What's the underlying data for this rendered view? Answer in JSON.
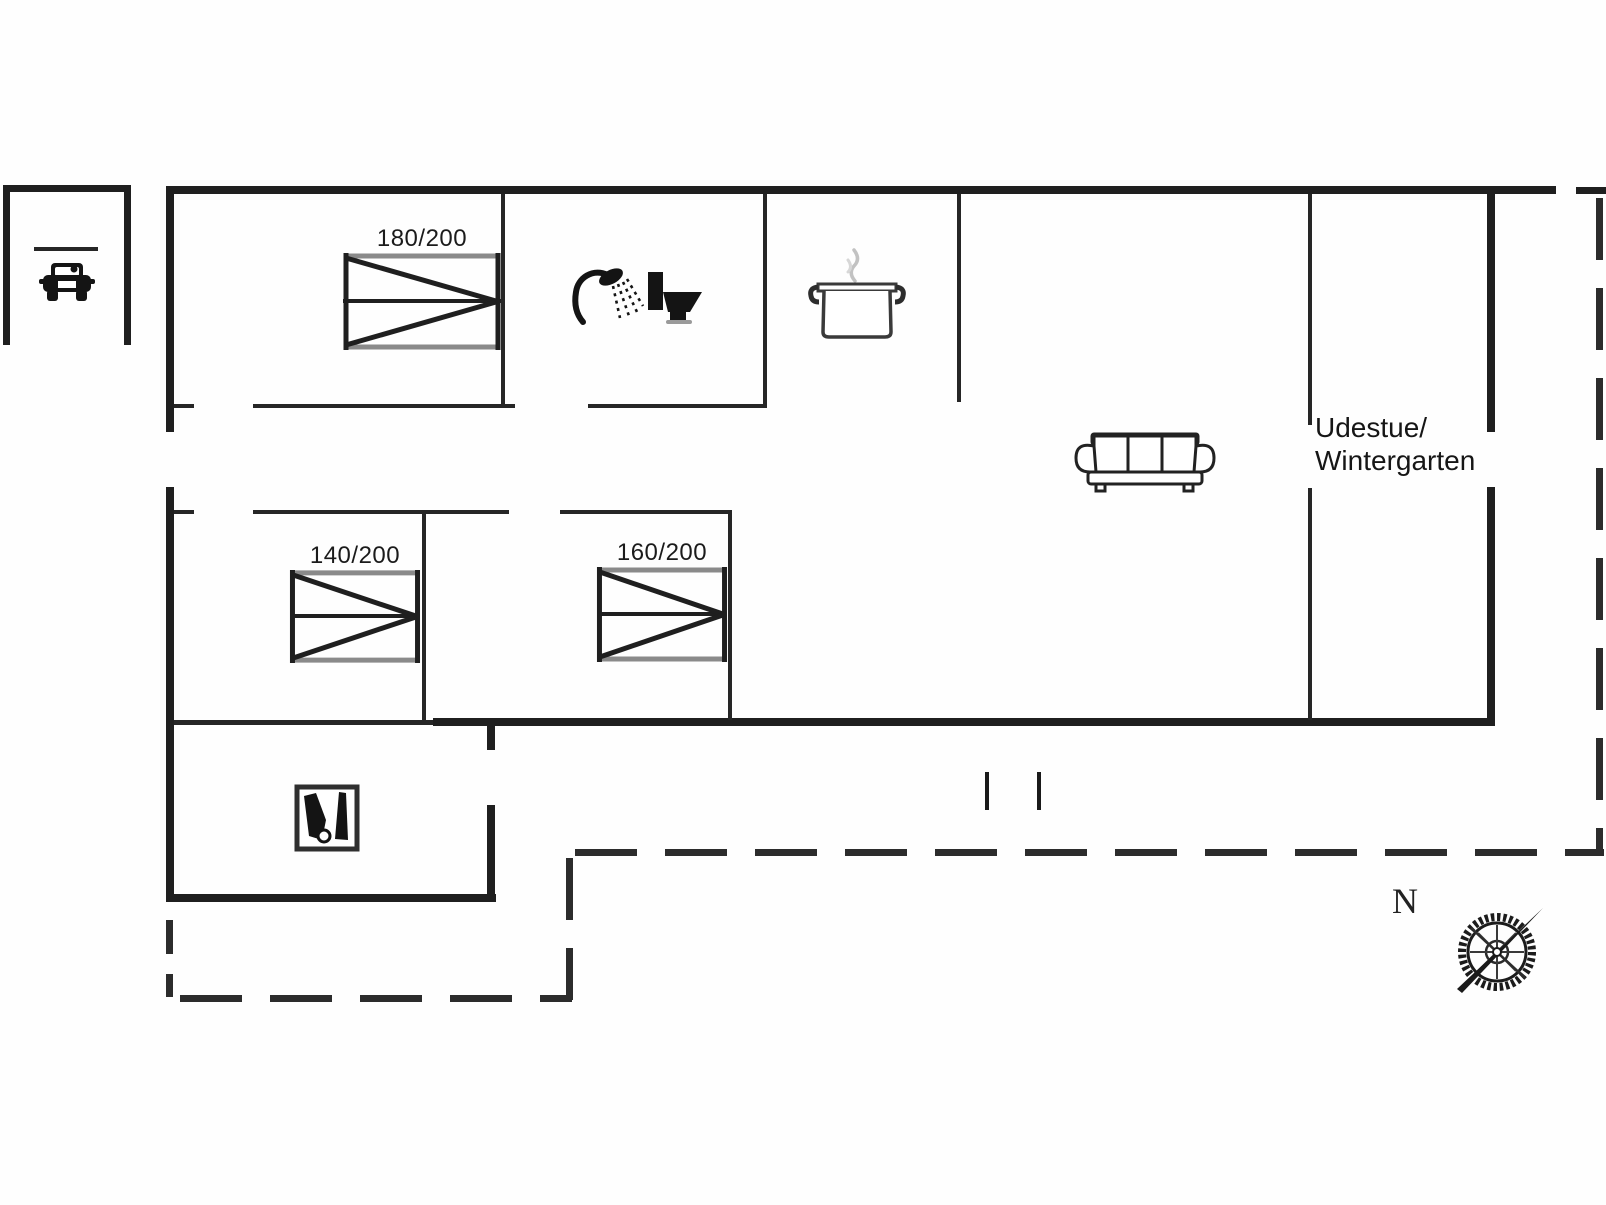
{
  "figure": {
    "type": "floor_plan",
    "room_label": {
      "line1": "Udestue/",
      "line2": "Wintergarten"
    },
    "beds": [
      {
        "id": "bed-1",
        "label": "180/200"
      },
      {
        "id": "bed-2",
        "label": "140/200"
      },
      {
        "id": "bed-3",
        "label": "160/200"
      }
    ],
    "compass": {
      "north_label": "N"
    },
    "icons": [
      "car-icon",
      "shower-icon",
      "toilet-icon",
      "cooking-pot-icon",
      "sofa-icon",
      "stove-icon",
      "compass-rose-icon"
    ],
    "colors": {
      "wall": "#1f1f1f",
      "interior_wall": "#262626",
      "dashed_line": "#2c2c2c",
      "bed_edge_gray": "#8a8a8a",
      "background": "#ffffff"
    }
  }
}
